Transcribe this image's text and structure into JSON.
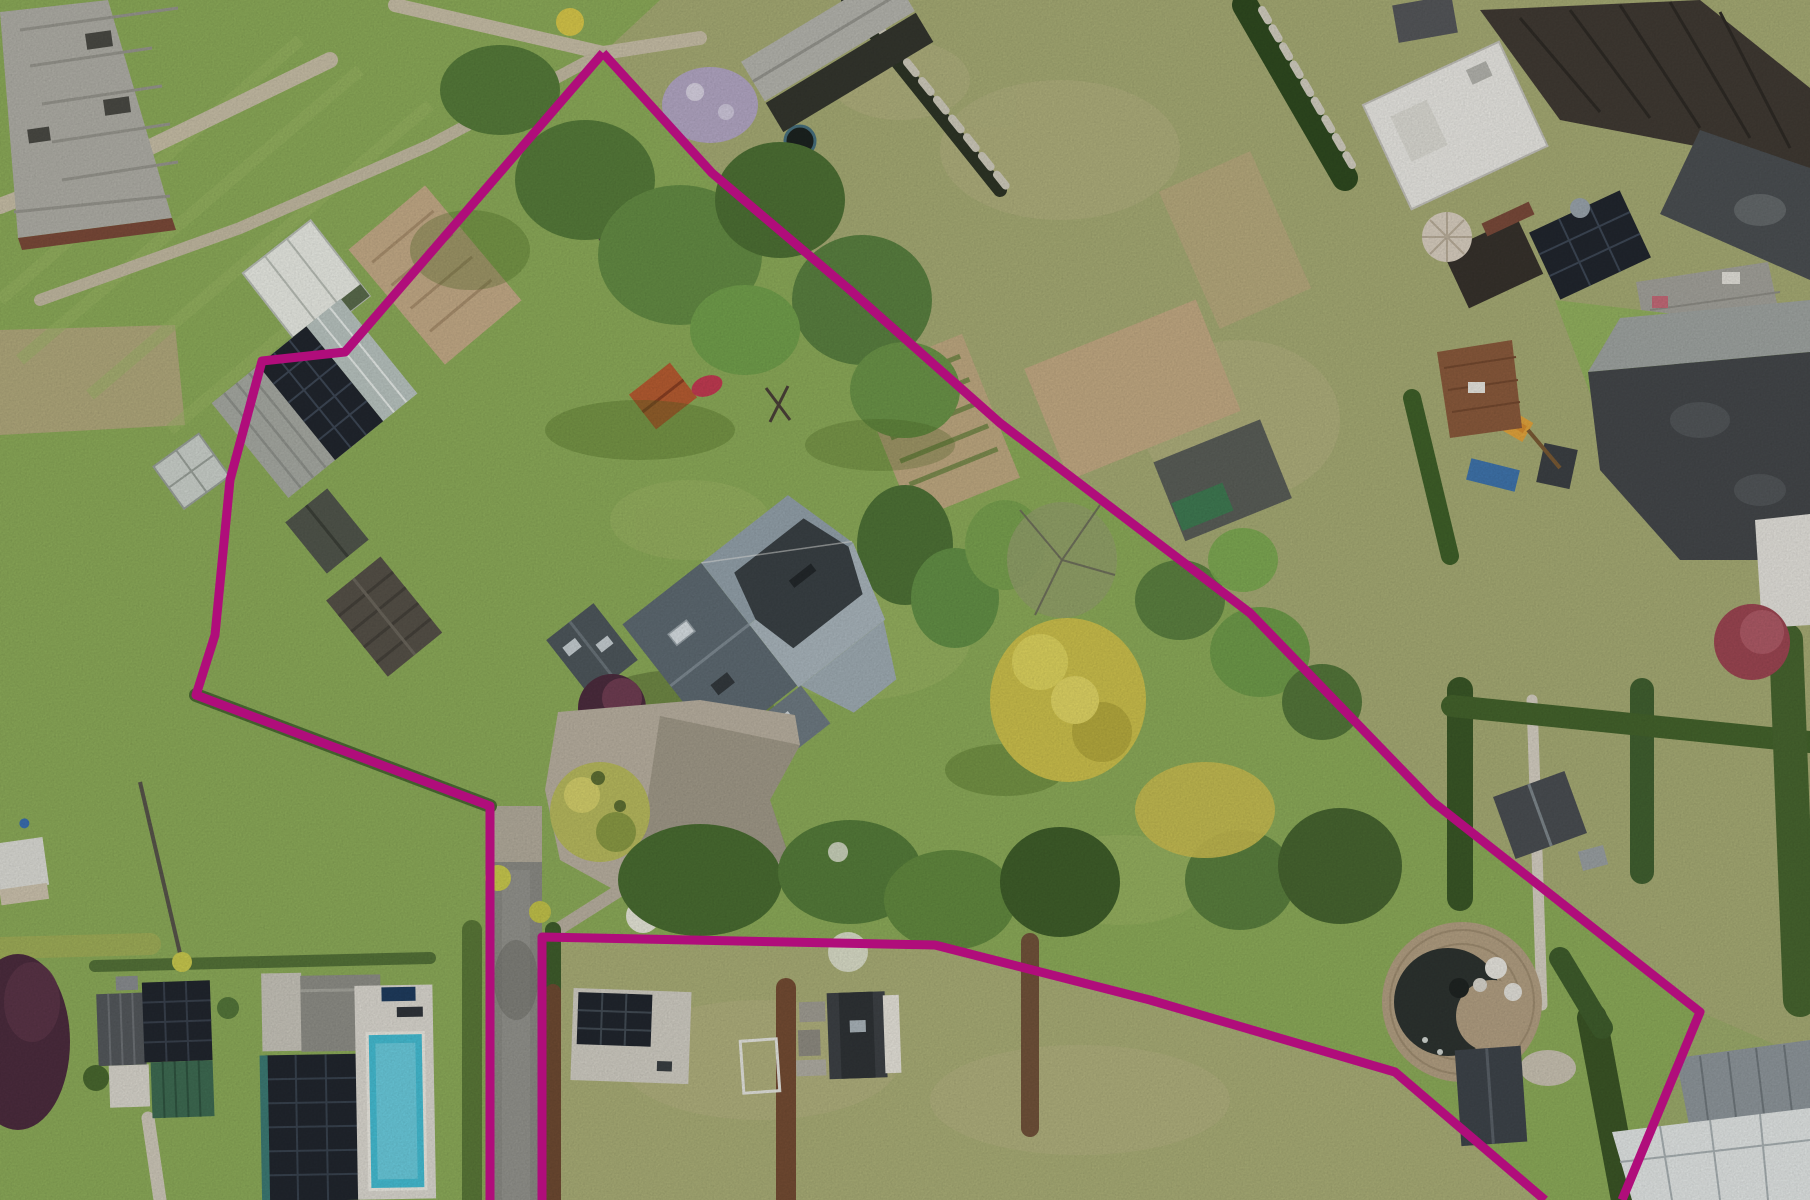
{
  "image": {
    "kind": "aerial-drone-photo",
    "subject": "residential property with garden plots, outlined plot boundary"
  },
  "boundary": {
    "color": "#b00d7b",
    "stroke_width": 9,
    "polylines": {
      "left_chain": "603,53 345,352 262,361 230,480 215,635 196,695 490,806 490,1200",
      "right_chain": "603,53 712,173 850,290 1000,423 1250,613 1433,802 1700,1012 1622,1200",
      "bottom_chain": "542,1200 542,937 935,945 1150,1000 1395,1072 1545,1200"
    }
  },
  "palette": {
    "lawn": "#8cab59",
    "meadow": "#a6ab74",
    "drygrass": "#a9ad76",
    "soil": "#c4ab87",
    "gravel": "#b9b0a0",
    "asphalt": "#8b8b85",
    "slate_roof": "#93a1aa",
    "dark_roof": "#3a4145",
    "solar_panel": "#21262e",
    "pool_water": "#45bdd3",
    "wood_deck": "#b29f82",
    "tree_dark": "#496c31",
    "tree_light": "#79a14f",
    "tree_yellow": "#ccc04c",
    "tree_purple": "#4c2c3e",
    "blossom_lilac": "#b3a7c4"
  },
  "features": [
    {
      "name": "plot-boundary-overlay"
    },
    {
      "name": "main-house-slate-roof"
    },
    {
      "name": "solar-barn"
    },
    {
      "name": "glass-greenhouse-white"
    },
    {
      "name": "glass-greenhouse-small"
    },
    {
      "name": "wooden-shed-brown"
    },
    {
      "name": "garden-shed-gray"
    },
    {
      "name": "red-tile-shed"
    },
    {
      "name": "gravel-courtyard"
    },
    {
      "name": "driveway-strip"
    },
    {
      "name": "swimming-pool"
    },
    {
      "name": "neighbor-house-solar-left"
    },
    {
      "name": "neighbor-house-solar-pool"
    },
    {
      "name": "garage-solar-pad"
    },
    {
      "name": "gambrel-shed-white-gable"
    },
    {
      "name": "circular-wood-deck-pond"
    },
    {
      "name": "rowhouse-complex-north-east"
    },
    {
      "name": "flat-roof-white"
    },
    {
      "name": "parasol"
    },
    {
      "name": "playground-slide"
    },
    {
      "name": "allotment-garden-beds"
    },
    {
      "name": "laburnum-yellow-tree"
    },
    {
      "name": "purple-beech-tree"
    },
    {
      "name": "wisteria-tree"
    },
    {
      "name": "greenhouses-bottom-right"
    },
    {
      "name": "corrugated-barn-top-left"
    }
  ]
}
